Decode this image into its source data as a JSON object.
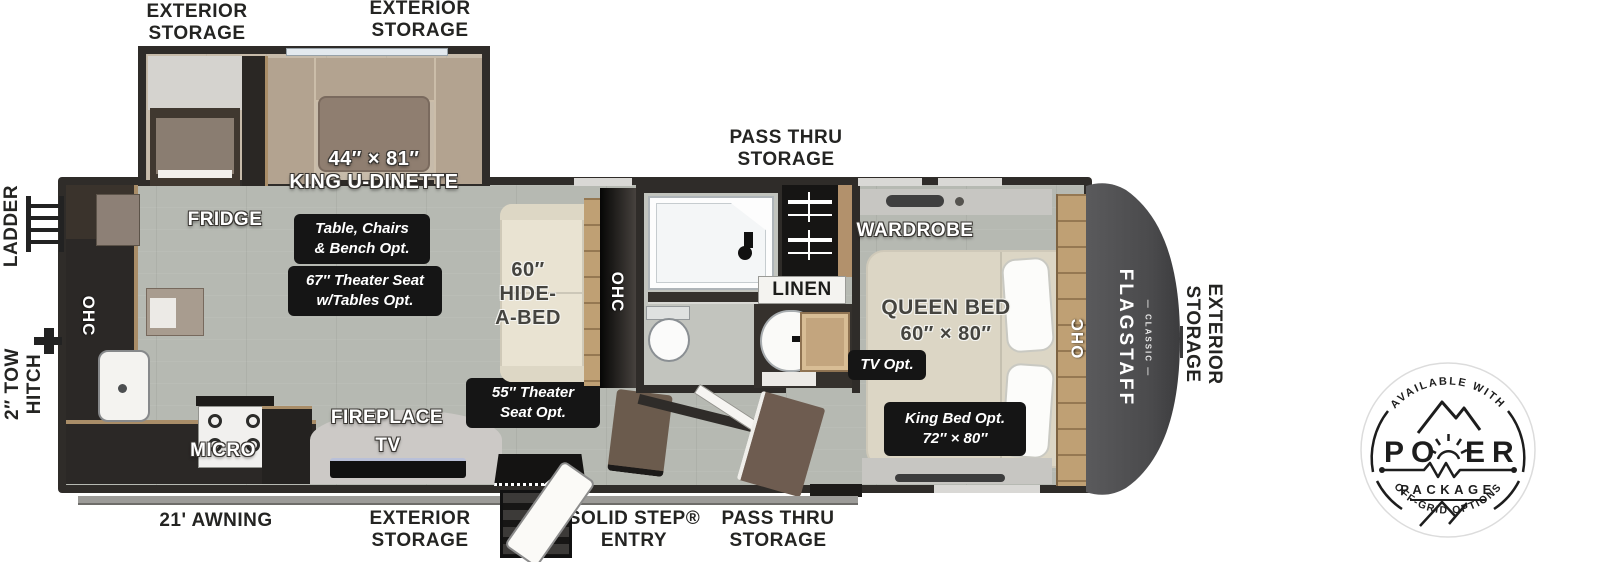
{
  "exterior": {
    "storage_top_left": "EXTERIOR\nSTORAGE",
    "storage_top_mid": "EXTERIOR\nSTORAGE",
    "pass_thru_top": "PASS THRU\nSTORAGE",
    "ladder": "LADDER",
    "tow_hitch": "2″ TOW\nHITCH",
    "storage_front": "EXTERIOR\nSTORAGE",
    "awning": "21' AWNING",
    "storage_bottom": "EXTERIOR\nSTORAGE",
    "entry": "SOLID STEP®\nENTRY",
    "pass_thru_bottom": "PASS THRU\nSTORAGE"
  },
  "interior": {
    "dinette_dims": "44″ × 81″",
    "dinette_name": "KING U-DINETTE",
    "fridge": "FRIDGE",
    "ohc": "OHC",
    "micro": "MICRO",
    "fireplace": "FIREPLACE",
    "tv": "TV",
    "hide_a_bed": "60″\nHIDE-\nA-BED",
    "linen": "LINEN",
    "wardrobe": "WARDROBE",
    "queen_bed": "QUEEN BED",
    "queen_dims": "60″ × 80″"
  },
  "options": {
    "dinette_opt": "Table, Chairs\n& Bench Opt.",
    "theater_67": "67″ Theater Seat\nw/Tables Opt.",
    "theater_55": "55″ Theater\nSeat Opt.",
    "tv_opt": "TV Opt.",
    "king_opt": "King Bed Opt.\n72″ × 80″"
  },
  "brand": {
    "name": "FLAGSTAFF",
    "series_display": "— CLASSIC —"
  },
  "power_badge": {
    "arc_top": "AVAILABLE WITH",
    "word_left": "PO",
    "word_right": "ER",
    "package": "PACKAGE",
    "arc_bottom": "OFF-GRID OPTIONS"
  },
  "colors": {
    "wall": "#2f2c29",
    "floor": "#b6b9b2",
    "slide_floor": "#c7bbaa",
    "wood_accent": "#c0a47c",
    "front_cap": "#4c4c4e",
    "badge_bg": "#151515"
  }
}
